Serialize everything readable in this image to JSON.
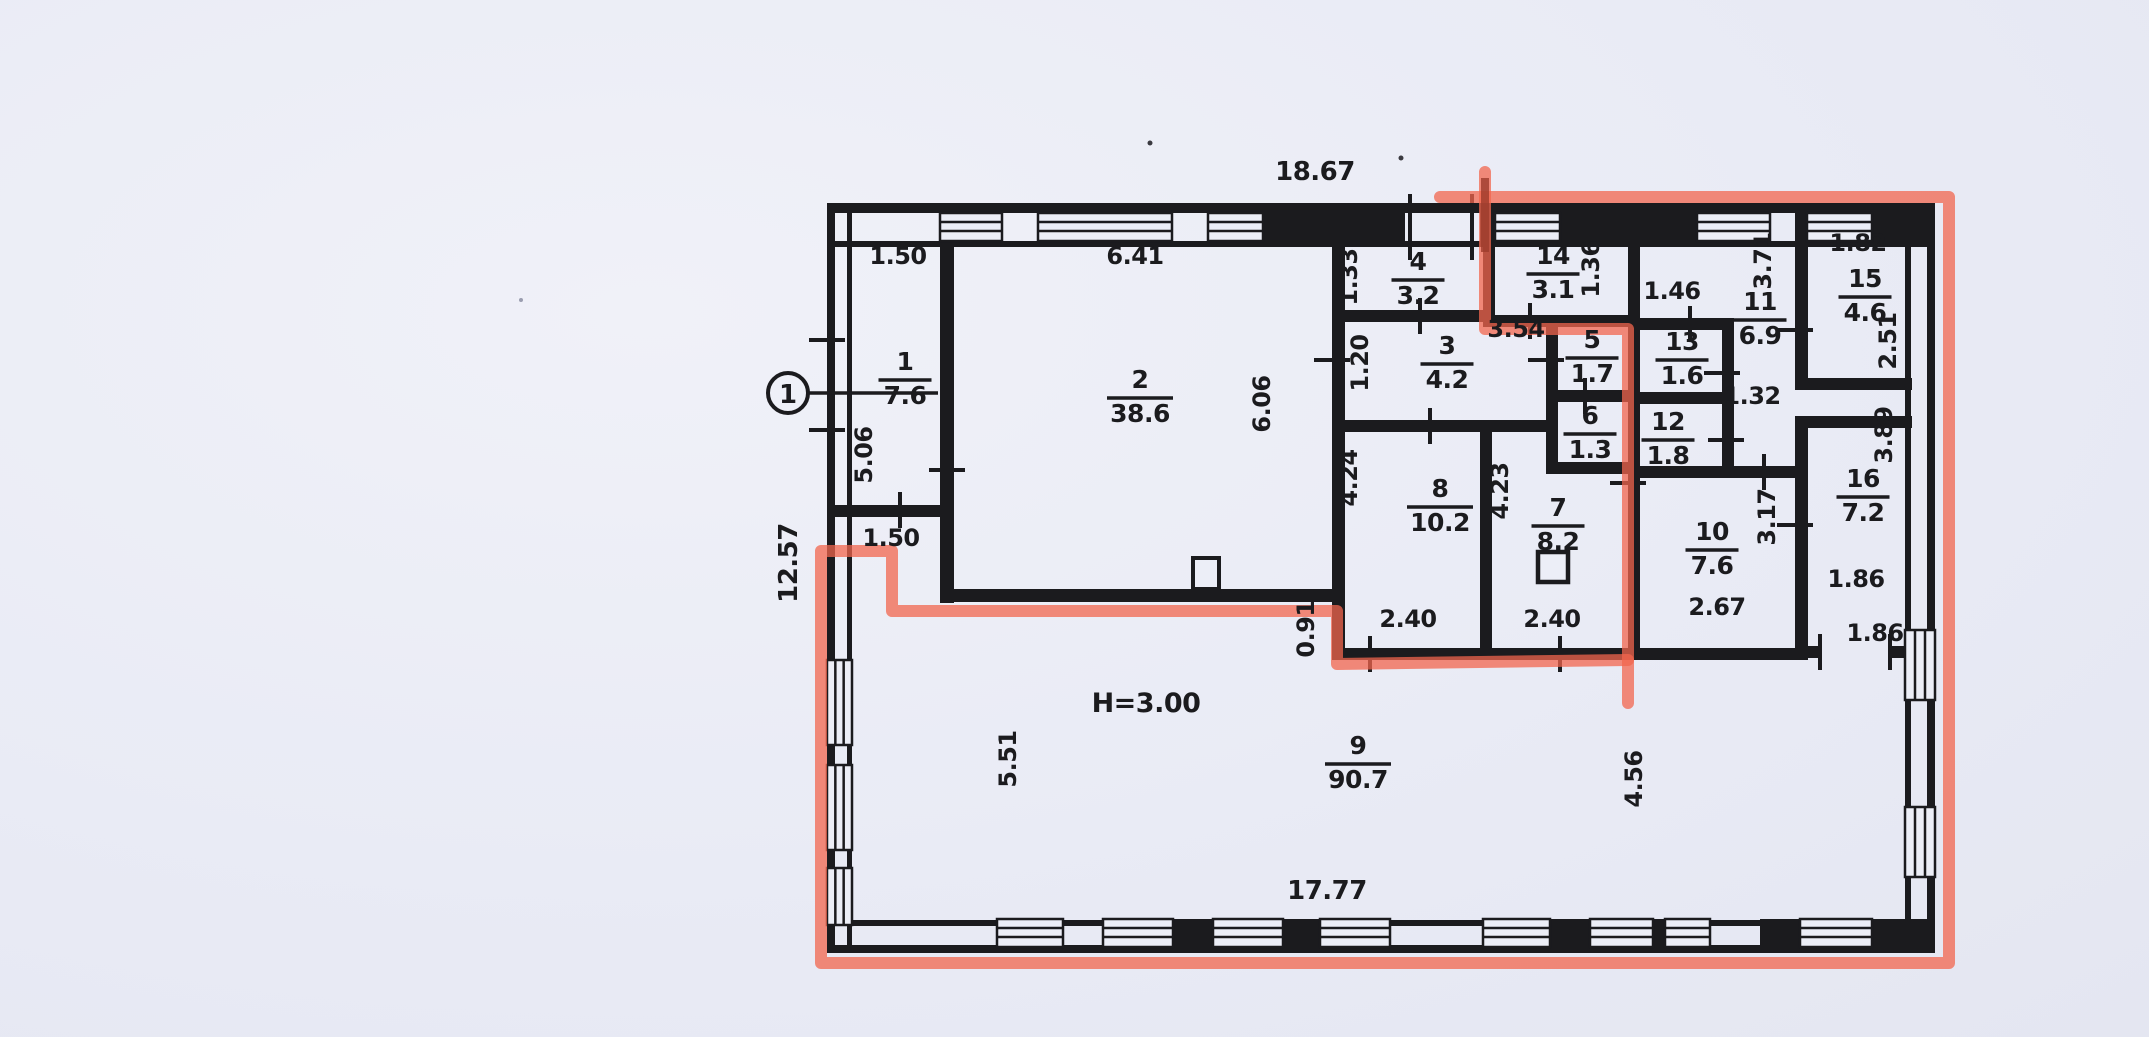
{
  "plan": {
    "axis_marker": "1",
    "height_note": "H=3.00",
    "colors": {
      "ink": "#1b1b1e",
      "highlight_red": "#f1664e",
      "highlight_red_dark": "#9e3c2c",
      "paper": "#eceef7"
    },
    "rooms": [
      {
        "num": "1",
        "area": "7.6",
        "x": 905,
        "y": 378
      },
      {
        "num": "2",
        "area": "38.6",
        "x": 1140,
        "y": 396
      },
      {
        "num": "3",
        "area": "4.2",
        "x": 1447,
        "y": 362
      },
      {
        "num": "4",
        "area": "3.2",
        "x": 1418,
        "y": 278
      },
      {
        "num": "5",
        "area": "1.7",
        "x": 1592,
        "y": 356
      },
      {
        "num": "6",
        "area": "1.3",
        "x": 1590,
        "y": 432
      },
      {
        "num": "7",
        "area": "8.2",
        "x": 1558,
        "y": 524
      },
      {
        "num": "8",
        "area": "10.2",
        "x": 1440,
        "y": 505
      },
      {
        "num": "9",
        "area": "90.7",
        "x": 1358,
        "y": 762
      },
      {
        "num": "10",
        "area": "7.6",
        "x": 1712,
        "y": 548
      },
      {
        "num": "11",
        "area": "6.9",
        "x": 1760,
        "y": 318
      },
      {
        "num": "12",
        "area": "1.8",
        "x": 1668,
        "y": 438
      },
      {
        "num": "13",
        "area": "1.6",
        "x": 1682,
        "y": 358
      },
      {
        "num": "14",
        "area": "3.1",
        "x": 1553,
        "y": 272
      },
      {
        "num": "15",
        "area": "4.6",
        "x": 1865,
        "y": 295
      },
      {
        "num": "16",
        "area": "7.2",
        "x": 1863,
        "y": 495
      }
    ],
    "dims": [
      {
        "t": "18.67",
        "x": 1315,
        "y": 180,
        "r": 0
      },
      {
        "t": "1.50",
        "x": 898,
        "y": 264,
        "r": 0
      },
      {
        "t": "6.41",
        "x": 1135,
        "y": 264,
        "r": 0
      },
      {
        "t": "1.33",
        "x": 1357,
        "y": 277,
        "r": -90
      },
      {
        "t": "1.36",
        "x": 1599,
        "y": 269,
        "r": -90
      },
      {
        "t": "1.46",
        "x": 1672,
        "y": 299,
        "r": 0
      },
      {
        "t": "3.71",
        "x": 1771,
        "y": 261,
        "r": -90
      },
      {
        "t": "1.82",
        "x": 1858,
        "y": 251,
        "r": 0
      },
      {
        "t": "2.51",
        "x": 1896,
        "y": 341,
        "r": -90
      },
      {
        "t": "1.20",
        "x": 1368,
        "y": 363,
        "r": -90
      },
      {
        "t": "3.54",
        "x": 1516,
        "y": 337,
        "r": 0
      },
      {
        "t": "6.06",
        "x": 1270,
        "y": 404,
        "r": -90
      },
      {
        "t": "1.32",
        "x": 1752,
        "y": 404,
        "r": 0
      },
      {
        "t": "5.06",
        "x": 872,
        "y": 455,
        "r": -90
      },
      {
        "t": "12.57",
        "x": 797,
        "y": 563,
        "r": -90
      },
      {
        "t": "1.50",
        "x": 891,
        "y": 546,
        "r": 0
      },
      {
        "t": "4.24",
        "x": 1357,
        "y": 478,
        "r": -90
      },
      {
        "t": "4.23",
        "x": 1508,
        "y": 491,
        "r": -90
      },
      {
        "t": "3.17",
        "x": 1775,
        "y": 517,
        "r": -90
      },
      {
        "t": "3.89",
        "x": 1892,
        "y": 435,
        "r": -90
      },
      {
        "t": "0.91",
        "x": 1314,
        "y": 629,
        "r": -90
      },
      {
        "t": "2.40",
        "x": 1408,
        "y": 627,
        "r": 0
      },
      {
        "t": "2.40",
        "x": 1552,
        "y": 627,
        "r": 0
      },
      {
        "t": "2.67",
        "x": 1717,
        "y": 615,
        "r": 0
      },
      {
        "t": "1.86",
        "x": 1856,
        "y": 587,
        "r": 0
      },
      {
        "t": "1.86",
        "x": 1875,
        "y": 641,
        "r": 0
      },
      {
        "t": "5.51",
        "x": 1016,
        "y": 759,
        "r": -90
      },
      {
        "t": "4.56",
        "x": 1642,
        "y": 779,
        "r": -90
      },
      {
        "t": "17.77",
        "x": 1327,
        "y": 899,
        "r": 0
      }
    ]
  }
}
